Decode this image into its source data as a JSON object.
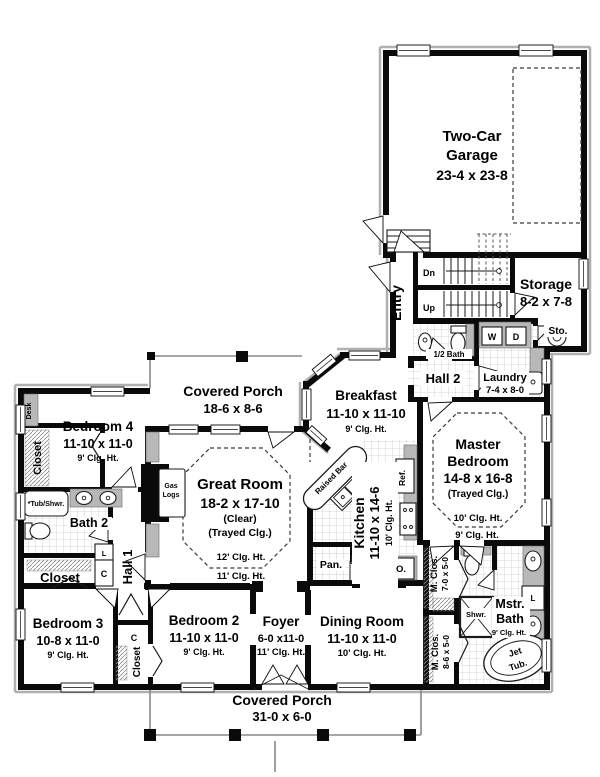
{
  "colors": {
    "wall": "#000000",
    "counter_gray": "#b8b8b8",
    "tile_line": "#cccccc",
    "trim_gray": "#b0b0b0"
  },
  "t": {
    "garage1": "Two-Car",
    "garage2": "Garage",
    "garage_d": "23-4 x 23-8",
    "storage": "Storage",
    "storage_d": "8-2 x 7-8",
    "sto": "Sto.",
    "entry": "Entry",
    "dn": "Dn",
    "up": "Up",
    "half_bath": "1/2 Bath",
    "w": "W",
    "d": "D",
    "laundry": "Laundry",
    "laundry_d": "7-4 x 8-0",
    "hall2": "Hall 2",
    "porch_top": "Covered Porch",
    "porch_top_d": "18-6 x 8-6",
    "breakfast": "Breakfast",
    "breakfast_d": "11-10 x 11-10",
    "breakfast_c": "9' Clg. Ht.",
    "bedroom4": "Bedroom 4",
    "bedroom4_d": "11-10 x 11-0",
    "bedroom4_c": "9' Clg. Ht.",
    "desk": "Desk",
    "closet_b4": "Closet",
    "great": "Great Room",
    "great_d": "18-2 x 17-10",
    "great_n1": "(Clear)",
    "great_n2": "(Trayed Clg.)",
    "great_c1": "12' Clg. Ht.",
    "great_c2": "11' Clg. Ht.",
    "gas1": "Gas",
    "gas2": "Logs",
    "kitchen": "Kitchen",
    "kitchen_d": "11-10 x 14-6",
    "kitchen_c": "10' Clg. Ht.",
    "raised_bar": "Raised Bar",
    "ref": "Ref.",
    "pan": "Pan.",
    "oven": "O.",
    "master1": "Master",
    "master2": "Bedroom",
    "master_d": "14-8 x 16-8",
    "master_n": "(Trayed Clg.)",
    "master_c1": "10' Clg. Ht.",
    "master_c2": "9' Clg. Ht.",
    "tubshwr": "*Tub/Shwr.",
    "bath2": "Bath 2",
    "closet_hall": "Closet",
    "c1": "C",
    "l1": "L",
    "hall1": "Hall 1",
    "bedroom3": "Bedroom 3",
    "bedroom3_d": "10-8 x 11-0",
    "bedroom3_c": "9' Clg. Ht.",
    "bedroom2": "Bedroom 2",
    "bedroom2_d": "11-10 x 11-0",
    "bedroom2_c": "9' Clg. Ht.",
    "closet_b2": "Closet",
    "c2": "C",
    "foyer": "Foyer",
    "foyer_d": "6-0 x11-0",
    "foyer_c": "11' Clg. Ht.",
    "dining": "Dining Room",
    "dining_d": "11-10 x 11-0",
    "dining_c": "10' Clg. Ht.",
    "mclos1": "M. Clos.",
    "mclos1_d": "7-0 x 5-0",
    "mclos2": "M. Clos.",
    "mclos2_d": "8-6 x 5-0",
    "shwr": "Shwr.",
    "mstr1": "Mstr.",
    "mstr2": "Bath",
    "mstr_c": "9' Clg. Ht.",
    "l2": "L",
    "jet1": "Jet",
    "jet2": "Tub.",
    "porch_bot": "Covered Porch",
    "porch_bot_d": "31-0 x 6-0"
  }
}
